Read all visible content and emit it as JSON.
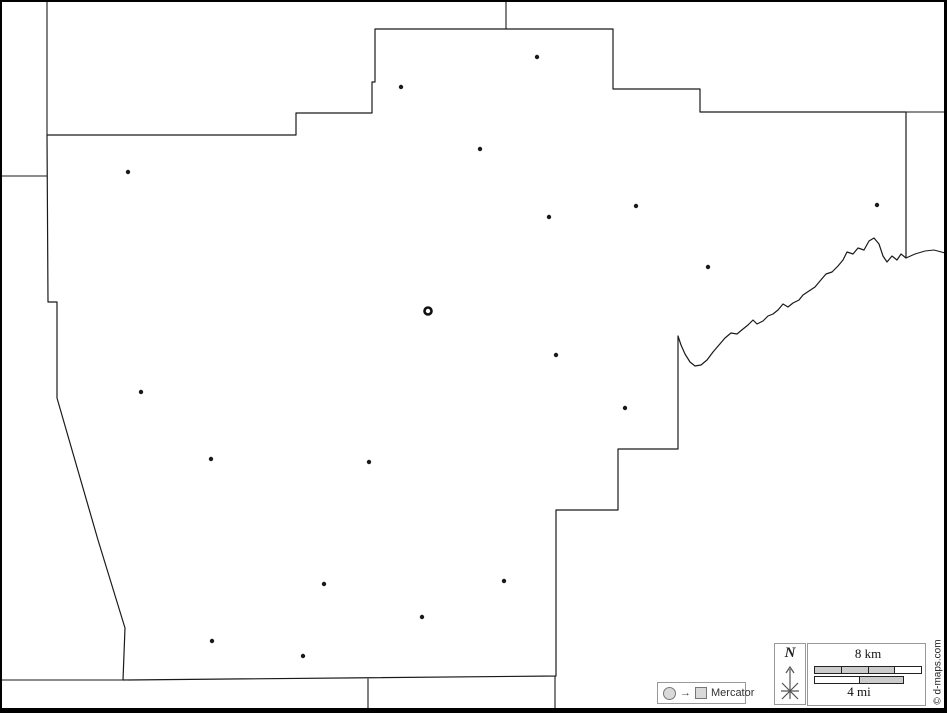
{
  "image": {
    "width": 947,
    "height": 713,
    "background": "#ffffff",
    "frame_color": "#000000"
  },
  "map": {
    "line_color": "#1a1a1a",
    "county_outline_path": "M47,135 L296,135 L296,113 L372,113 L372,82 L375,82 L375,29 L613,29 L613,89 L700,89 L700,112 L906,112 L906,258 L901,254 L897,260 L892,256 L887,262 L883,256 L879,244 L874,238 L869,241 L864,250 L858,248 L853,254 L847,252 L843,260 L838,266 L832,272 L826,274 L820,281 L815,287 L809,291 L803,295 L799,300 L793,303 L788,307 L783,304 L778,310 L773,314 L768,316 L763,321 L757,324 L753,320 L748,325 L743,329 L737,334 L731,333 L725,338 L719,345 L713,352 L707,360 L701,365 L695,366 L690,362 L685,354 L681,345 L678,336 L678,449 L618,449 L618,510 L556,510 L556,676 L123,680 L125,628 L98,540 L57,398 L57,302 L48,302 Z",
    "neighbor_lines": [
      "M47,2 L47,135",
      "M2,176 L47,176",
      "M506,2 L506,29",
      "M906,112 L945,112",
      "M906,258 L915,254 L925,251 L934,250 L945,253",
      "M2,680 L123,680",
      "M368,679 L368,708",
      "M555,676 L555,708"
    ],
    "towns": [
      [
        128,
        172
      ],
      [
        401,
        87
      ],
      [
        537,
        57
      ],
      [
        480,
        149
      ],
      [
        549,
        217
      ],
      [
        636,
        206
      ],
      [
        877,
        205
      ],
      [
        708,
        267
      ],
      [
        556,
        355
      ],
      [
        625,
        408
      ],
      [
        141,
        392
      ],
      [
        211,
        459
      ],
      [
        369,
        462
      ],
      [
        324,
        584
      ],
      [
        504,
        581
      ],
      [
        422,
        617
      ],
      [
        212,
        641
      ],
      [
        303,
        656
      ]
    ],
    "town_dot_radius": 2.2,
    "county_seat": {
      "x": 428,
      "y": 311,
      "radius": 3.5,
      "ring_width": 2.6
    }
  },
  "legend": {
    "projection_box": {
      "label": "Mercator",
      "symbols": [
        "circle-icon",
        "arrow-right-icon",
        "square-icon"
      ],
      "arrow_glyph": "→"
    },
    "compass": {
      "label": "N"
    },
    "scale_bar": {
      "km_label": "8 km",
      "mi_label": "4 mi",
      "km_segments": [
        "#cccccc",
        "#cccccc",
        "#cccccc",
        "#ffffff"
      ],
      "mi_segments": [
        "#ffffff",
        "#cccccc"
      ]
    },
    "copyright": "© d-maps.com"
  }
}
